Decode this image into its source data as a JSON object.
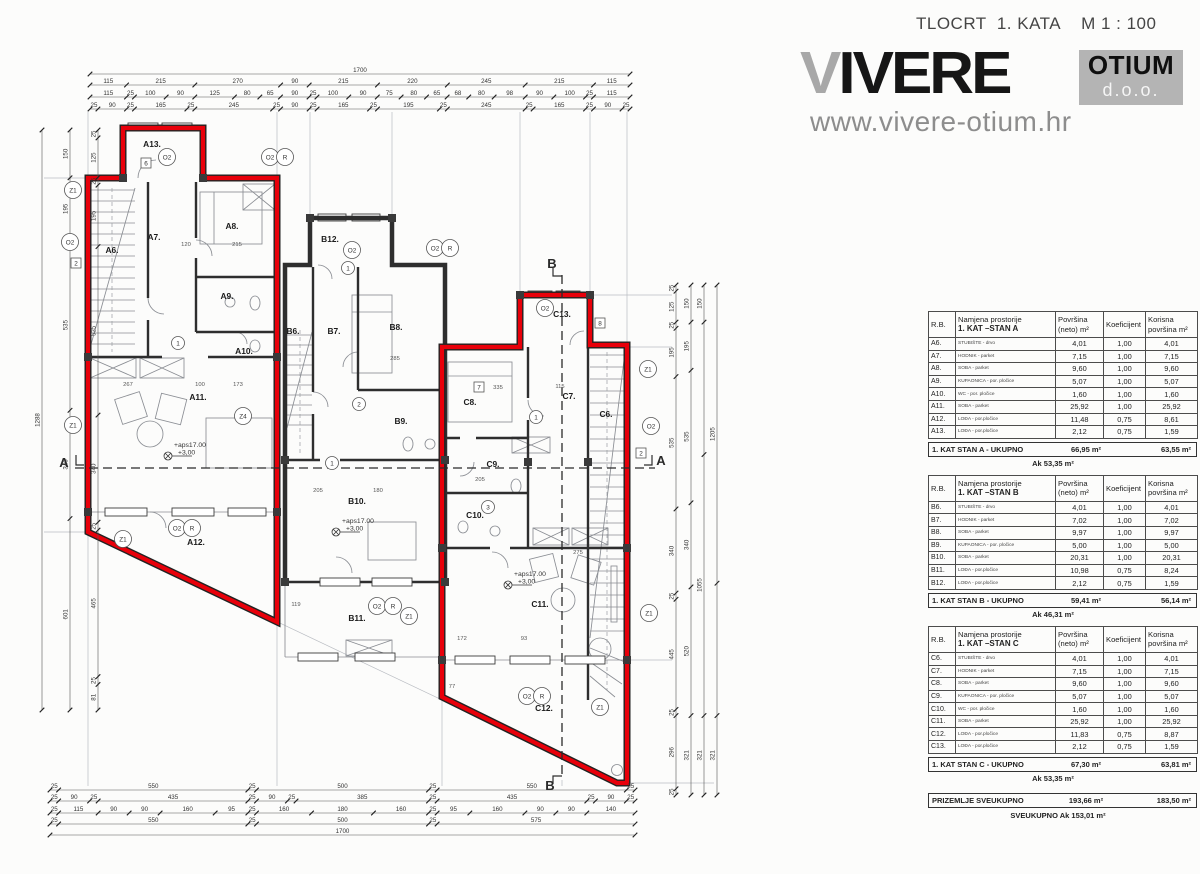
{
  "header": {
    "title": "TLOCRT  1. KATA    M 1 : 100",
    "logo_v": "V",
    "logo_rest": "IVERE",
    "badge_line1": "OTIUM",
    "badge_line2": "d.o.o.",
    "website": "www.vivere-otium.hr"
  },
  "colors": {
    "outline_red": "#e8000a",
    "wall_dark": "#2e2e2e",
    "logo_gray": "#a8a8a8",
    "badge_gray": "#b4b4b4"
  },
  "tables": [
    {
      "headers": {
        "rb": "R.B.",
        "name1": "Namjena prostorije",
        "name2": "1. KAT –STAN A",
        "area1": "Površina",
        "area2": "(neto) m²",
        "koef": "Koeficijent",
        "kor1": "Korisna",
        "kor2": "površina m²"
      },
      "rows": [
        {
          "rb": "A6.",
          "name": "STUBIŠTE - drvo",
          "neto": "4,01",
          "koef": "1,00",
          "korisna": "4,01"
        },
        {
          "rb": "A7.",
          "name": "HODNIK - parket",
          "neto": "7,15",
          "koef": "1,00",
          "korisna": "7,15"
        },
        {
          "rb": "A8.",
          "name": "SOBA - parket",
          "neto": "9,60",
          "koef": "1,00",
          "korisna": "9,60"
        },
        {
          "rb": "A9.",
          "name": "KUPAONICA - por. pločice",
          "neto": "5,07",
          "koef": "1,00",
          "korisna": "5,07"
        },
        {
          "rb": "A10.",
          "name": "WC - por. pločice",
          "neto": "1,60",
          "koef": "1,00",
          "korisna": "1,60"
        },
        {
          "rb": "A11.",
          "name": "SOBA - parket",
          "neto": "25,92",
          "koef": "1,00",
          "korisna": "25,92"
        },
        {
          "rb": "A12.",
          "name": "LOĐA - por.pločice",
          "neto": "11,48",
          "koef": "0,75",
          "korisna": "8,61"
        },
        {
          "rb": "A13.",
          "name": "LOĐA - por.pločice",
          "neto": "2,12",
          "koef": "0,75",
          "korisna": "1,59"
        }
      ],
      "total_label": "1. KAT STAN A - UKUPNO",
      "total_neto": "66,95 m²",
      "total_korisna": "63,55 m²",
      "ak": "Ak 53,35 m²"
    },
    {
      "headers": {
        "rb": "R.B.",
        "name1": "Namjena prostorije",
        "name2": "1. KAT –STAN B",
        "area1": "Površina",
        "area2": "(neto) m²",
        "koef": "Koeficijent",
        "kor1": "Korisna",
        "kor2": "površina m²"
      },
      "rows": [
        {
          "rb": "B6.",
          "name": "STUBIŠTE - drvo",
          "neto": "4,01",
          "koef": "1,00",
          "korisna": "4,01"
        },
        {
          "rb": "B7.",
          "name": "HODNIK - parket",
          "neto": "7,02",
          "koef": "1,00",
          "korisna": "7,02"
        },
        {
          "rb": "B8.",
          "name": "SOBA - parket",
          "neto": "9,97",
          "koef": "1,00",
          "korisna": "9,97"
        },
        {
          "rb": "B9.",
          "name": "KUPAONICA - por. pločice",
          "neto": "5,00",
          "koef": "1,00",
          "korisna": "5,00"
        },
        {
          "rb": "B10.",
          "name": "SOBA - parket",
          "neto": "20,31",
          "koef": "1,00",
          "korisna": "20,31"
        },
        {
          "rb": "B11.",
          "name": "LOĐA - por.pločice",
          "neto": "10,98",
          "koef": "0,75",
          "korisna": "8,24"
        },
        {
          "rb": "B12.",
          "name": "LOĐA - por.pločice",
          "neto": "2,12",
          "koef": "0,75",
          "korisna": "1,59"
        }
      ],
      "total_label": "1. KAT STAN B - UKUPNO",
      "total_neto": "59,41 m²",
      "total_korisna": "56,14 m²",
      "ak": "Ak 46,31 m²"
    },
    {
      "headers": {
        "rb": "R.B.",
        "name1": "Namjena prostorije",
        "name2": "1. KAT –STAN C",
        "area1": "Površina",
        "area2": "(neto) m²",
        "koef": "Koeficijent",
        "kor1": "Korisna",
        "kor2": "površina m²"
      },
      "rows": [
        {
          "rb": "C6.",
          "name": "STUBIŠTE - drvo",
          "neto": "4,01",
          "koef": "1,00",
          "korisna": "4,01"
        },
        {
          "rb": "C7.",
          "name": "HODNIK - parket",
          "neto": "7,15",
          "koef": "1,00",
          "korisna": "7,15"
        },
        {
          "rb": "C8.",
          "name": "SOBA - parket",
          "neto": "9,60",
          "koef": "1,00",
          "korisna": "9,60"
        },
        {
          "rb": "C9.",
          "name": "KUPAONICA - por. pločice",
          "neto": "5,07",
          "koef": "1,00",
          "korisna": "5,07"
        },
        {
          "rb": "C10.",
          "name": "WC - por. pločice",
          "neto": "1,60",
          "koef": "1,00",
          "korisna": "1,60"
        },
        {
          "rb": "C11.",
          "name": "SOBA - parket",
          "neto": "25,92",
          "koef": "1,00",
          "korisna": "25,92"
        },
        {
          "rb": "C12.",
          "name": "LOĐA - por.pločice",
          "neto": "11,83",
          "koef": "0,75",
          "korisna": "8,87"
        },
        {
          "rb": "C13.",
          "name": "LOĐA - por.pločice",
          "neto": "2,12",
          "koef": "0,75",
          "korisna": "1,59"
        }
      ],
      "total_label": "1. KAT STAN C - UKUPNO",
      "total_neto": "67,30 m²",
      "total_korisna": "63,81 m²",
      "ak": "Ak 53,35 m²"
    }
  ],
  "summary": {
    "label": "PRIZEMLJE SVEUKUPNO",
    "neto": "193,66 m²",
    "korisna": "183,50 m²",
    "ak": "SVEUKUPNO  Ak 153,01 m²"
  },
  "plan": {
    "dims": {
      "top1": {
        "segs": [
          1700
        ]
      },
      "top2": {
        "segs": [
          115,
          215,
          270,
          90,
          215,
          220,
          245,
          215,
          115
        ]
      },
      "top3": {
        "segs": [
          115,
          25,
          100,
          90,
          125,
          80,
          65,
          90,
          25,
          100,
          90,
          75,
          80,
          65,
          68,
          80,
          98,
          90,
          100,
          25,
          115
        ]
      },
      "top4": {
        "segs": [
          25,
          90,
          25,
          165,
          25,
          245,
          25,
          90,
          25,
          165,
          25,
          195,
          25,
          245,
          25,
          165,
          25,
          90,
          25
        ]
      },
      "bot1": {
        "segs": [
          25,
          550,
          25,
          500,
          25,
          550,
          25
        ]
      },
      "bot2": {
        "segs": [
          25,
          90,
          25,
          435,
          25,
          90,
          25,
          385,
          25,
          435,
          25,
          90,
          25
        ]
      },
      "bot3": {
        "segs": [
          25,
          115,
          90,
          90,
          160,
          95,
          25,
          160,
          180,
          160,
          25,
          95,
          160,
          90,
          90,
          140
        ]
      },
      "bot4": {
        "segs": [
          25,
          550,
          25,
          500,
          25,
          575
        ]
      },
      "bot5": {
        "segs": [
          1700
        ]
      },
      "left1": {
        "segs": [
          1288
        ]
      },
      "left2": {
        "segs": [
          150,
          195,
          535,
          340,
          601
        ]
      },
      "left3": {
        "segs": [
          25,
          125,
          25,
          195,
          535,
          340,
          25,
          465,
          25,
          81
        ]
      },
      "right1": {
        "segs": [
          25,
          125,
          25,
          195,
          535,
          340,
          25,
          445,
          25,
          296,
          25
        ]
      },
      "right2": {
        "segs": [
          150,
          195,
          535,
          340,
          520,
          321
        ]
      },
      "right3": {
        "segs": [
          150,
          535,
          1055,
          321
        ],
        "labels": [
          "150",
          "",
          "1055",
          "321"
        ]
      },
      "right4": {
        "segs": [
          1205,
          535,
          321
        ],
        "labels": [
          "1205",
          "",
          "321"
        ]
      }
    },
    "rooms": [
      {
        "label": "A6.",
        "x": 112,
        "y": 253
      },
      {
        "label": "A7.",
        "x": 154,
        "y": 240
      },
      {
        "label": "A8.",
        "x": 232,
        "y": 229
      },
      {
        "label": "A9.",
        "x": 227,
        "y": 299
      },
      {
        "label": "A10.",
        "x": 244,
        "y": 354
      },
      {
        "label": "A11.",
        "x": 198,
        "y": 400
      },
      {
        "label": "A12.",
        "x": 196,
        "y": 545
      },
      {
        "label": "A13.",
        "x": 152,
        "y": 147
      },
      {
        "label": "B6.",
        "x": 293,
        "y": 334
      },
      {
        "label": "B7.",
        "x": 334,
        "y": 334
      },
      {
        "label": "B8.",
        "x": 396,
        "y": 330
      },
      {
        "label": "B9.",
        "x": 401,
        "y": 424
      },
      {
        "label": "B10.",
        "x": 357,
        "y": 504
      },
      {
        "label": "B11.",
        "x": 357,
        "y": 621
      },
      {
        "label": "B12.",
        "x": 330,
        "y": 242
      },
      {
        "label": "C6.",
        "x": 606,
        "y": 417
      },
      {
        "label": "C7.",
        "x": 569,
        "y": 399
      },
      {
        "label": "C8.",
        "x": 470,
        "y": 405
      },
      {
        "label": "C9.",
        "x": 493,
        "y": 467
      },
      {
        "label": "C10.",
        "x": 475,
        "y": 518
      },
      {
        "label": "C11.",
        "x": 540,
        "y": 607
      },
      {
        "label": "C12.",
        "x": 544,
        "y": 711
      },
      {
        "label": "C13.",
        "x": 562,
        "y": 317
      }
    ],
    "tags": [
      {
        "t": "Z1",
        "x": 73,
        "y": 190,
        "k": "c"
      },
      {
        "t": "O2",
        "x": 70,
        "y": 242,
        "k": "c"
      },
      {
        "t": "Z1",
        "x": 73,
        "y": 425,
        "k": "c"
      },
      {
        "t": "O2",
        "x": 167,
        "y": 157,
        "k": "c"
      },
      {
        "t": "O2",
        "x": 270,
        "y": 157,
        "k": "c"
      },
      {
        "t": "R",
        "x": 285,
        "y": 157,
        "k": "c"
      },
      {
        "t": "O2",
        "x": 352,
        "y": 250,
        "k": "c"
      },
      {
        "t": "O2",
        "x": 435,
        "y": 248,
        "k": "c"
      },
      {
        "t": "R",
        "x": 450,
        "y": 248,
        "k": "c"
      },
      {
        "t": "O2",
        "x": 545,
        "y": 308,
        "k": "c"
      },
      {
        "t": "O2",
        "x": 177,
        "y": 528,
        "k": "c"
      },
      {
        "t": "R",
        "x": 192,
        "y": 528,
        "k": "c"
      },
      {
        "t": "Z1",
        "x": 123,
        "y": 539,
        "k": "c"
      },
      {
        "t": "Z4",
        "x": 243,
        "y": 416,
        "k": "c"
      },
      {
        "t": "O2",
        "x": 377,
        "y": 606,
        "k": "c"
      },
      {
        "t": "R",
        "x": 393,
        "y": 606,
        "k": "c"
      },
      {
        "t": "Z1",
        "x": 409,
        "y": 616,
        "k": "c"
      },
      {
        "t": "O2",
        "x": 527,
        "y": 696,
        "k": "c"
      },
      {
        "t": "R",
        "x": 542,
        "y": 696,
        "k": "c"
      },
      {
        "t": "Z1",
        "x": 600,
        "y": 707,
        "k": "c"
      },
      {
        "t": "Z1",
        "x": 649,
        "y": 613,
        "k": "c"
      },
      {
        "t": "Z1",
        "x": 648,
        "y": 369,
        "k": "c"
      },
      {
        "t": "O2",
        "x": 651,
        "y": 426,
        "k": "c"
      },
      {
        "t": "1",
        "x": 178,
        "y": 343,
        "k": "s"
      },
      {
        "t": "2",
        "x": 359,
        "y": 404,
        "k": "s"
      },
      {
        "t": "1",
        "x": 332,
        "y": 463,
        "k": "s"
      },
      {
        "t": "3",
        "x": 488,
        "y": 507,
        "k": "s"
      },
      {
        "t": "1",
        "x": 536,
        "y": 417,
        "k": "s"
      },
      {
        "t": "1",
        "x": 348,
        "y": 268,
        "k": "s"
      },
      {
        "t": "2",
        "x": 76,
        "y": 263,
        "k": "b"
      },
      {
        "t": "2",
        "x": 641,
        "y": 453,
        "k": "b"
      },
      {
        "t": "8",
        "x": 600,
        "y": 323,
        "k": "b"
      },
      {
        "t": "6",
        "x": 146,
        "y": 163,
        "k": "b"
      },
      {
        "t": "7",
        "x": 479,
        "y": 387,
        "k": "b"
      }
    ],
    "inner_dims": [
      {
        "t": "215",
        "x": 237,
        "y": 246
      },
      {
        "t": "120",
        "x": 186,
        "y": 246
      },
      {
        "t": "267",
        "x": 128,
        "y": 386
      },
      {
        "t": "100",
        "x": 200,
        "y": 386
      },
      {
        "t": "173",
        "x": 238,
        "y": 386
      },
      {
        "t": "335",
        "x": 498,
        "y": 389
      },
      {
        "t": "115",
        "x": 560,
        "y": 388
      },
      {
        "t": "205",
        "x": 480,
        "y": 481
      },
      {
        "t": "275",
        "x": 578,
        "y": 554
      },
      {
        "t": "285",
        "x": 395,
        "y": 360
      },
      {
        "t": "205",
        "x": 318,
        "y": 492
      },
      {
        "t": "180",
        "x": 378,
        "y": 492
      },
      {
        "t": "119",
        "x": 296,
        "y": 606
      },
      {
        "t": "77",
        "x": 452,
        "y": 688
      },
      {
        "t": "172",
        "x": 462,
        "y": 640
      },
      {
        "t": "93",
        "x": 524,
        "y": 640
      }
    ],
    "elevations": [
      {
        "x": 168,
        "y": 446
      },
      {
        "x": 336,
        "y": 522
      },
      {
        "x": 508,
        "y": 575
      }
    ],
    "elevation_line1": "+aps17.00",
    "elevation_line2": "+3,00",
    "sections": [
      {
        "t": "A",
        "x": 64,
        "y": 467
      },
      {
        "t": "A",
        "x": 661,
        "y": 465
      },
      {
        "t": "B",
        "x": 552,
        "y": 268
      },
      {
        "t": "B",
        "x": 550,
        "y": 790
      }
    ]
  }
}
